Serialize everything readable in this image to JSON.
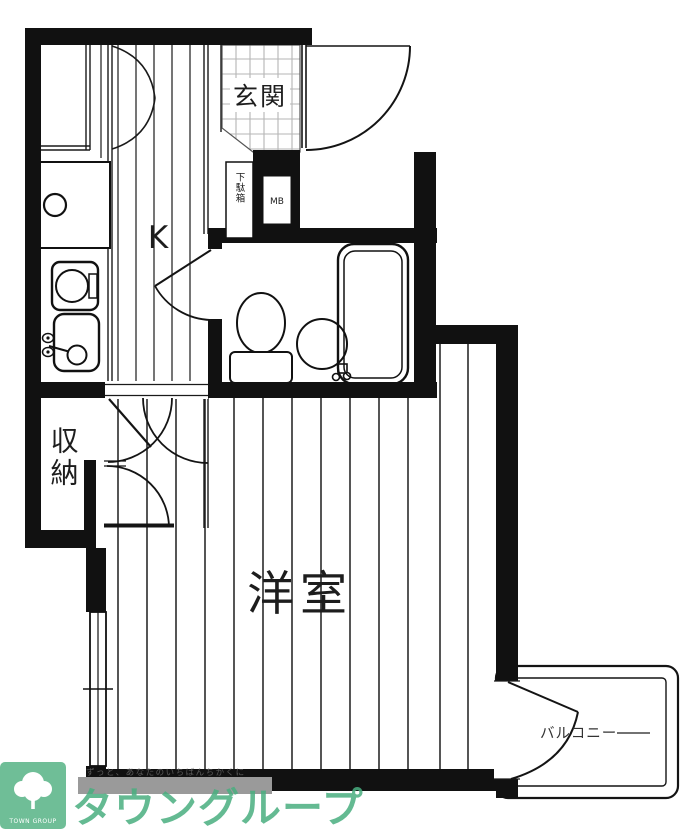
{
  "page": {
    "background": "#ffffff"
  },
  "floorplan": {
    "rooms": {
      "entrance": "玄関",
      "kitchen": "K",
      "western_room": "洋室",
      "storage": "収納",
      "balcony": "バルコニー"
    },
    "fixtures": {
      "shoe_box": "下駄箱",
      "meter_box": "MB"
    },
    "colors": {
      "wall": "#111111",
      "floor_line": "#2b2b2b",
      "tile_line": "#b5b5b5"
    }
  },
  "branding": {
    "company": "タウングループ",
    "logo_caption": "TOWN GROUP",
    "tagline": "ずっと、あなたのいちばんちかくに",
    "brand_green": "#49ae80",
    "logo_green": "#6fbe97",
    "watermark_bar": "#9a9a9a"
  }
}
